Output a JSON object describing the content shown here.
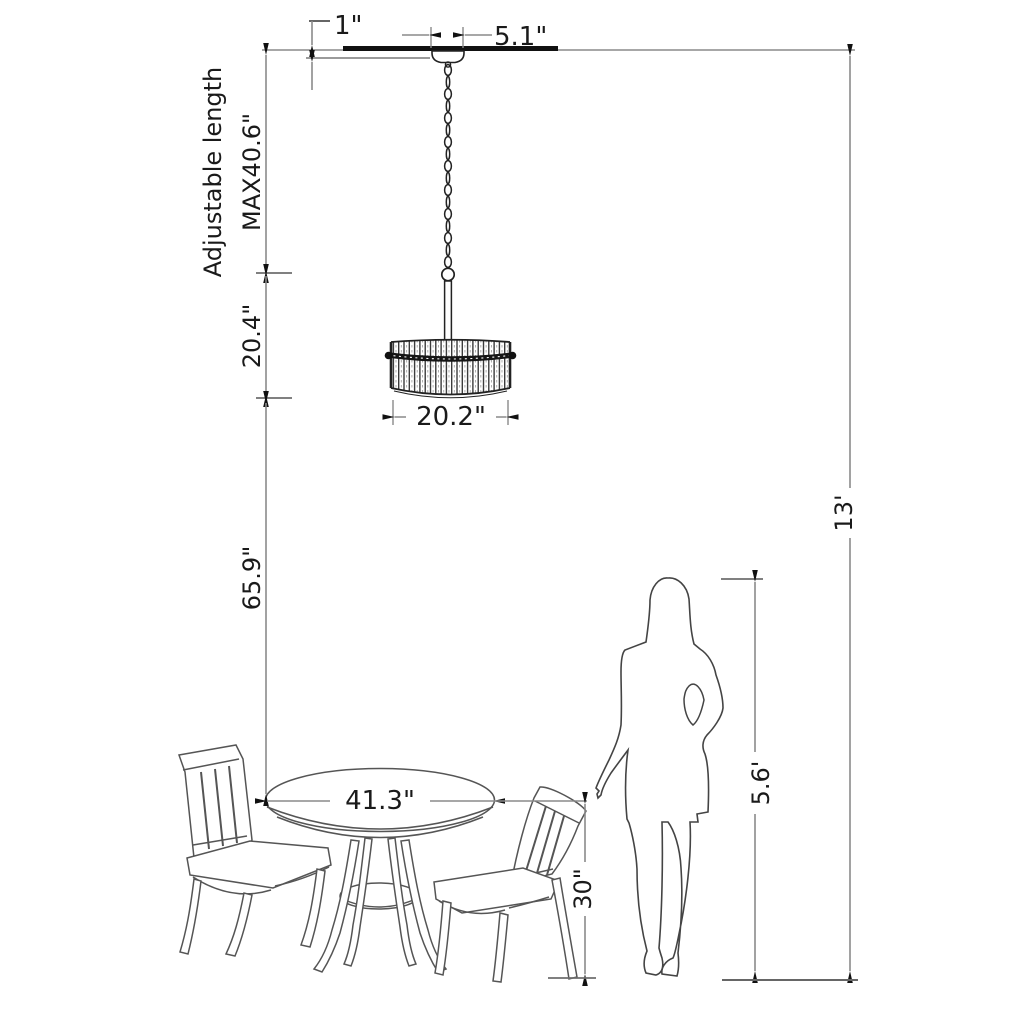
{
  "diagram": {
    "kind": "product dimension line drawing",
    "objects": [
      "ceiling-line",
      "canopy",
      "chain",
      "drum-chandelier",
      "round-dining-table",
      "side-chair-left",
      "side-chair-right",
      "woman-silhouette",
      "floor-line"
    ],
    "labels": {
      "drop_offset": "1\"",
      "canopy_width": "5.1\"",
      "adjustable_note": "Adjustable length",
      "max_length": "MAX40.6\"",
      "shade_height": "20.4\"",
      "shade_width": "20.2\"",
      "clearance_below": "65.9\"",
      "table_width": "41.3\"",
      "table_height": "30\"",
      "person_height": "5.6'",
      "ceiling_height": "13'"
    },
    "dimensions": [
      {
        "name": "ceiling drop offset",
        "value": "1\""
      },
      {
        "name": "canopy width",
        "value": "5.1\""
      },
      {
        "name": "maximum adjustable hanging length",
        "value": "MAX40.6\""
      },
      {
        "name": "fixture height",
        "value": "20.4\""
      },
      {
        "name": "shade diameter",
        "value": "20.2\""
      },
      {
        "name": "clearance fixture to table",
        "value": "65.9\""
      },
      {
        "name": "table diameter",
        "value": "41.3\""
      },
      {
        "name": "table height",
        "value": "30\""
      },
      {
        "name": "person height",
        "value": "5.6'"
      },
      {
        "name": "ceiling height",
        "value": "13'"
      }
    ],
    "colors": {
      "background": "#ffffff",
      "ink": "#1a1a1a",
      "dimension_line": "#8a8a8a",
      "drawing_line": "#555555"
    }
  }
}
